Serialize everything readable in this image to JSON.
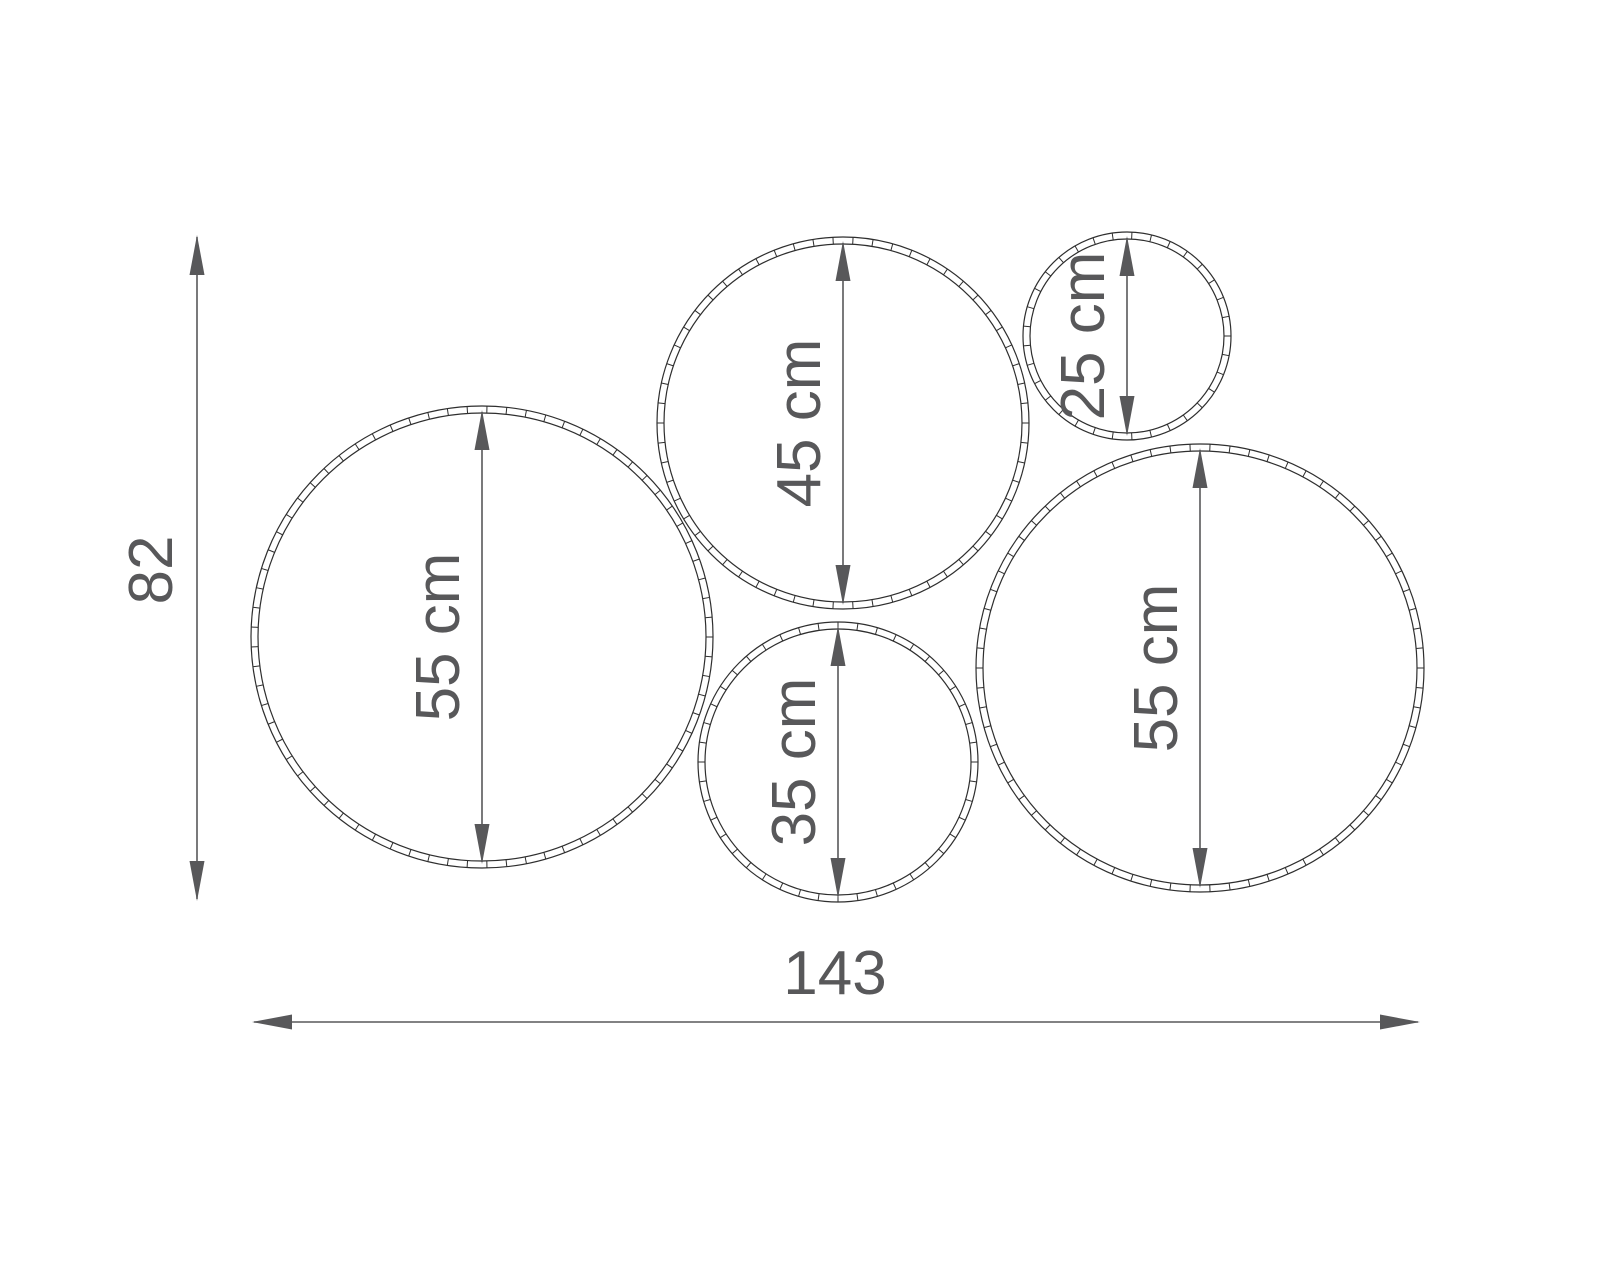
{
  "canvas": {
    "width": 1600,
    "height": 1280,
    "background": "#ffffff"
  },
  "style": {
    "ring_color": "#2e2e2e",
    "ring_thickness": 7,
    "ring_tick_spacing": 20,
    "dim_color": "#58585a",
    "text_color": "#58585a",
    "label_offset_x": -43
  },
  "circles": [
    {
      "name": "left-large",
      "label": "55 cm",
      "diameter_cm": 55,
      "cx": 482,
      "cy": 637,
      "r": 231
    },
    {
      "name": "top-middle",
      "label": "45 cm",
      "diameter_cm": 45,
      "cx": 843,
      "cy": 423,
      "r": 186
    },
    {
      "name": "top-right-small",
      "label": "25 cm",
      "diameter_cm": 25,
      "cx": 1127,
      "cy": 336,
      "r": 104
    },
    {
      "name": "bottom-middle",
      "label": "35 cm",
      "diameter_cm": 35,
      "cx": 838,
      "cy": 762,
      "r": 140
    },
    {
      "name": "right-large",
      "label": "55 cm",
      "diameter_cm": 55,
      "cx": 1200,
      "cy": 668,
      "r": 224
    }
  ],
  "dimensions": {
    "height": {
      "label": "82",
      "value_cm": 82,
      "x": 197,
      "y1": 235,
      "y2": 901,
      "label_x": 152,
      "label_y": 570
    },
    "width": {
      "label": "143",
      "value_cm": 143,
      "y": 1022,
      "x1": 252,
      "x2": 1420,
      "label_x": 835,
      "label_y": 974
    }
  }
}
